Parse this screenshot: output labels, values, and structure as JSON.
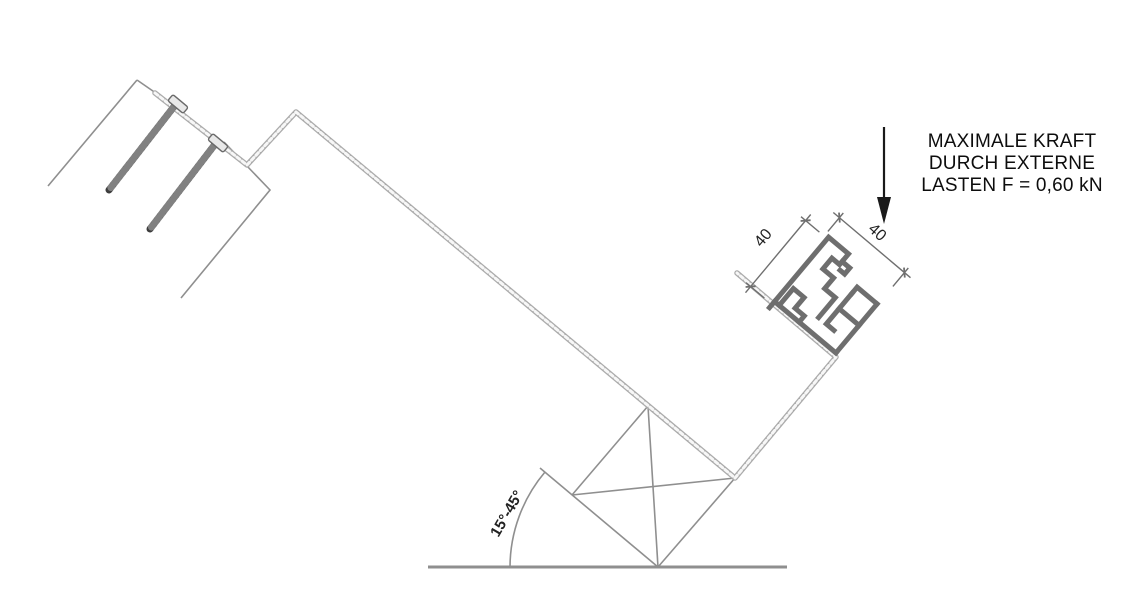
{
  "diagram": {
    "force_annotation": {
      "line1": "MAXIMALE KRAFT",
      "line2": "DURCH EXTERNE",
      "line3": "LASTEN F = 0,60 kN"
    },
    "dimensions": {
      "left": "40",
      "right": "40"
    },
    "angle_label": "15°-45°",
    "icons": {
      "force_arrow": "arrow-down-icon"
    },
    "colors": {
      "sheet": "#ababab",
      "sheet_highlight": "#ffffff",
      "profile": "#6e6e6e",
      "screw": "#3d3d3d",
      "screw_head_fill": "#e8e8e8",
      "thin_line": "#8f8f8f",
      "ground": "#8f8f8f",
      "dim_line": "#6f6f6f",
      "arrow": "#1a1a1a",
      "text": "#0d0d0d"
    }
  }
}
